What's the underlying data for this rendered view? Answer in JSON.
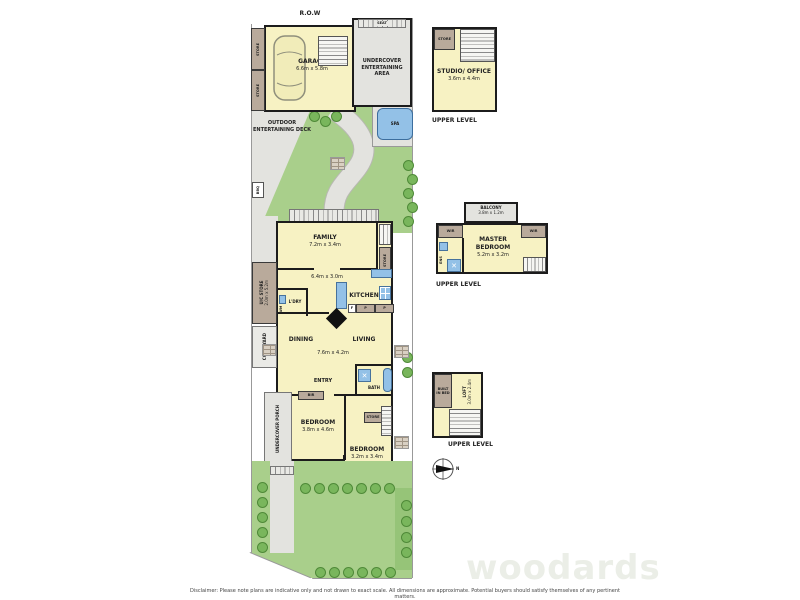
{
  "colors": {
    "room_fill": "#f7f2c3",
    "paving": "#e3e3df",
    "lawn": "#a9cf8b",
    "shrub": "#79b65c",
    "wardrobe": "#b9aa9b",
    "water": "#93c1e7",
    "wall": "#1c1c1c"
  },
  "site": {
    "row_label": "R.O.W"
  },
  "rear": {
    "store_upper": "STORE",
    "store_lower": "STORE",
    "garage_name": "GARAGE",
    "garage_dims": "6.6m x 5.8m",
    "seat": "SEAT",
    "entertaining_area": "UNDERCOVER ENTERTAINING AREA"
  },
  "garden": {
    "deck": "OUTDOOR ENTERTAINING DECK",
    "spa": "SPA",
    "bbq": "BBQ"
  },
  "house": {
    "family": "FAMILY",
    "family_dims": "7.2m x 3.4m",
    "meals_dims": "6.4m x 3.0m",
    "kitchen": "KITCHEN",
    "pantry_left": "P",
    "pantry_right": "P",
    "fridge": "F",
    "laundry": "L'DRY",
    "wm": "WM",
    "store_family": "STORE",
    "uc_store": "U/C STORE",
    "uc_store_dims": "2.0m x 5.2m",
    "courtyard": "COURTYARD",
    "dining": "DINING",
    "living": "LIVING",
    "living_dims": "7.6m x 4.2m",
    "entry": "ENTRY",
    "bath": "BATH",
    "bir": "BIR",
    "bedroom1": "BEDROOM",
    "bedroom1_dims": "3.8m x 4.6m",
    "store_hall": "STORE",
    "bedroom2": "BEDROOM",
    "bedroom2_dims": "3.2m x 3.4m",
    "porch": "UNDERCOVER PORCH"
  },
  "upper_studio": {
    "store": "STORE",
    "name": "STUDIO/ OFFICE",
    "dims": "3.6m x 4.4m",
    "level": "UPPER LEVEL"
  },
  "upper_master": {
    "balcony": "BALCONY",
    "balcony_dims": "3.8m x 1.2m",
    "wir_left": "WIR",
    "wir_right": "WIR",
    "ens": "ENS",
    "name": "MASTER BEDROOM",
    "dims": "5.2m x 3.2m",
    "level": "UPPER LEVEL"
  },
  "upper_loft": {
    "built_in_bed": "BUILT IN BED",
    "name": "LOFT",
    "dims": "3.0m x 2.4m",
    "level": "UPPER LEVEL"
  },
  "compass": {
    "north": "N"
  },
  "footer": {
    "watermark": "woodards",
    "disclaimer": "Disclaimer: Please note plans are indicative only and not drawn to exact scale. All dimensions are approximate. Potential buyers should satisfy themselves of any pertinent matters."
  }
}
